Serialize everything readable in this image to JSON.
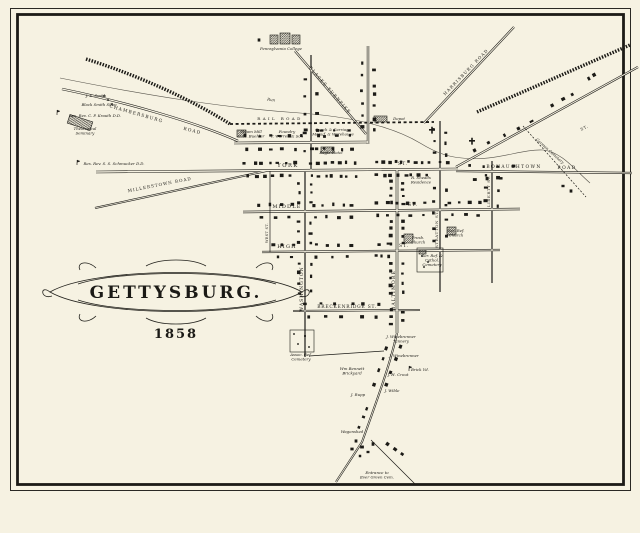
{
  "title": {
    "text": "GETTYSBURG.",
    "year": "1858"
  },
  "map": {
    "background": "#f6f2e2",
    "ink": "#1c1b17",
    "stream_color": "#55524a",
    "roads": [
      {
        "name": "stream-run",
        "kind": "stream",
        "d": "M 60 78 C 150 96 225 108 300 113 C 355 117 395 128 420 143 C 438 154 450 157 462 158 C 495 162 520 149 543 150 C 562 152 575 170 590 183"
      },
      {
        "name": "chambersburg-road",
        "kind": "double",
        "w": 2.4,
        "d": "M 62 89 C 125 102 195 122 238 141"
      },
      {
        "name": "blacks-turnpike",
        "kind": "double",
        "w": 2.2,
        "d": "M 295 51 L 366 134"
      },
      {
        "name": "harrisburg-road",
        "kind": "double",
        "w": 2.2,
        "d": "M 514 27 L 424 123"
      },
      {
        "name": "carlisle-st",
        "kind": "double",
        "w": 2.4,
        "d": "M 368 46 L 368 144"
      },
      {
        "name": "washington-st-north",
        "kind": "double",
        "w": 2,
        "d": "M 311 55 L 311 170"
      },
      {
        "name": "chambersburg-st",
        "kind": "double",
        "w": 2.6,
        "d": "M 234 143 L 368 142"
      },
      {
        "name": "york-st",
        "kind": "double",
        "w": 2.6,
        "d": "M 96 172 L 458 169"
      },
      {
        "name": "middle-st",
        "kind": "double",
        "w": 2.4,
        "d": "M 243 212 L 520 209"
      },
      {
        "name": "high-st",
        "kind": "double",
        "w": 2.2,
        "d": "M 262 252 L 500 250"
      },
      {
        "name": "breckenridge-st",
        "kind": "double",
        "w": 2,
        "d": "M 293 311 L 420 310"
      },
      {
        "name": "west-st",
        "kind": "thin",
        "d": "M 270 171 L 270 252"
      },
      {
        "name": "washington-st-south",
        "kind": "double",
        "w": 2,
        "d": "M 305 170 L 305 357"
      },
      {
        "name": "baltimore-st",
        "kind": "double",
        "w": 2.6,
        "d": "M 397 169 L 397 333"
      },
      {
        "name": "stratton-st",
        "kind": "double",
        "w": 2,
        "d": "M 440 121 L 440 292"
      },
      {
        "name": "liberty-st",
        "kind": "double",
        "w": 2,
        "d": "M 492 161 L 492 283"
      },
      {
        "name": "bonaughtown-road",
        "kind": "double",
        "w": 2.2,
        "d": "M 456 171 L 632 173"
      },
      {
        "name": "york-pike",
        "kind": "double",
        "w": 2.2,
        "d": "M 456 167 L 638 67"
      },
      {
        "name": "baltimore-pike-south",
        "kind": "double",
        "w": 2,
        "d": "M 397 333 C 390 365 377 400 362 442 L 336 482"
      },
      {
        "name": "millerstown-road",
        "kind": "double",
        "w": 2,
        "d": "M 95 208 L 266 171"
      },
      {
        "name": "evergreen-cemetery-lane",
        "kind": "thin",
        "d": "M 371 440 L 415 484"
      },
      {
        "name": "cemetery-lane-west",
        "kind": "thin",
        "d": "M 309 356 L 384 351"
      },
      {
        "name": "german-cemetery-lane",
        "kind": "lane",
        "d": "M 523 126 L 586 197"
      },
      {
        "name": "railroad-northwest",
        "kind": "band",
        "d": "M 86 59 C 140 76 192 100 230 124"
      },
      {
        "name": "railroad-center",
        "kind": "dash",
        "d": "M 230 124 L 434 122"
      },
      {
        "name": "railroad-northeast",
        "kind": "band",
        "d": "M 477 112 L 630 45"
      }
    ],
    "street_labels": [
      {
        "t": "RAIL ROAD",
        "x": 280,
        "y": 120,
        "r": 0,
        "s": 4,
        "sp": 2.4
      },
      {
        "t": "YORK",
        "x": 288,
        "y": 167,
        "r": 0,
        "s": 5.2,
        "sp": 1.5
      },
      {
        "t": "ST.",
        "x": 403,
        "y": 165,
        "r": 0,
        "s": 4.6,
        "sp": 1
      },
      {
        "t": "MIDDLE",
        "x": 287,
        "y": 208,
        "r": 0,
        "s": 5,
        "sp": 1.2
      },
      {
        "t": "ST.",
        "x": 413,
        "y": 206,
        "r": 0,
        "s": 4.6,
        "sp": 1
      },
      {
        "t": "HIGH",
        "x": 287,
        "y": 248,
        "r": 0,
        "s": 5,
        "sp": 1.2
      },
      {
        "t": "ST.",
        "x": 404,
        "y": 247,
        "r": 0,
        "s": 4.6,
        "sp": 1
      },
      {
        "t": "BRECKENRIDGE ST.",
        "x": 347,
        "y": 308,
        "r": 0,
        "s": 4.4,
        "sp": 0.8
      },
      {
        "t": "WASHINGTON",
        "x": 303,
        "y": 289,
        "r": -90,
        "s": 4.6,
        "sp": 1
      },
      {
        "t": "BALTIMORE",
        "x": 395,
        "y": 290,
        "r": -90,
        "s": 4.6,
        "sp": 1.2
      },
      {
        "t": "STRATTON ST.",
        "x": 438,
        "y": 229,
        "r": -90,
        "s": 4,
        "sp": 0.6
      },
      {
        "t": "LIBERTY ST.",
        "x": 490,
        "y": 191,
        "r": -90,
        "s": 4,
        "sp": 0.6
      },
      {
        "t": "WEST ST.",
        "x": 268,
        "y": 233,
        "r": -90,
        "s": 3.4,
        "sp": 0.4
      },
      {
        "t": "BONAUGHTOWN",
        "x": 514,
        "y": 168,
        "r": 0,
        "s": 4.4,
        "sp": 1.4
      },
      {
        "t": "ROAD",
        "x": 567,
        "y": 169,
        "r": 0,
        "s": 4.4,
        "sp": 1.4
      },
      {
        "t": "CHAMBERSBURG",
        "x": 136,
        "y": 115,
        "r": 16,
        "s": 4.4,
        "sp": 1.2
      },
      {
        "t": "ROAD",
        "x": 192,
        "y": 132,
        "r": 14,
        "s": 4.4,
        "sp": 1.2
      },
      {
        "t": "MILLERSTOWN ROAD",
        "x": 160,
        "y": 186,
        "r": -11,
        "s": 4.2,
        "sp": 1
      },
      {
        "t": "BLACKS TURNPIKE",
        "x": 329,
        "y": 91,
        "r": 49,
        "s": 4.2,
        "sp": 1.2
      },
      {
        "t": "HARRISBURG ROAD",
        "x": 467,
        "y": 73,
        "r": -46,
        "s": 4.2,
        "sp": 1.2
      },
      {
        "t": "ST.",
        "x": 585,
        "y": 129,
        "r": -27,
        "s": 4,
        "sp": 0.8
      }
    ],
    "script_labels": [
      {
        "l": [
          "Pennsylvania College"
        ],
        "x": 281,
        "y": 50
      },
      {
        "l": [
          "J. S. Smith"
        ],
        "x": 96,
        "y": 97
      },
      {
        "l": [
          "Black Smith Shop"
        ],
        "x": 99,
        "y": 106
      },
      {
        "l": [
          "Res. Rev. C. P. Krauth D.D."
        ],
        "x": 95,
        "y": 117
      },
      {
        "l": [
          "Theological",
          "Seminary"
        ],
        "x": 85,
        "y": 130
      },
      {
        "l": [
          "Res. Rev. S. S. Schmucker D.D."
        ],
        "x": 114,
        "y": 165
      },
      {
        "l": [
          "Run"
        ],
        "x": 271,
        "y": 101,
        "r": 8
      },
      {
        "l": [
          "Steam Mill",
          "C. H. Buehler"
        ],
        "x": 251,
        "y": 133
      },
      {
        "l": [
          "Foundry",
          "T. Warren & Son"
        ],
        "x": 287,
        "y": 133
      },
      {
        "l": [
          "Coach & Carriage",
          "Manuf. & Warehouse"
        ],
        "x": 333,
        "y": 131
      },
      {
        "l": [
          "Depot"
        ],
        "x": 399,
        "y": 120
      },
      {
        "l": [
          "Eagle Hotel"
        ],
        "x": 331,
        "y": 154
      },
      {
        "l": [
          "R. Sheads",
          "Residence"
        ],
        "x": 421,
        "y": 179
      },
      {
        "l": [
          "Presb.",
          "Church"
        ],
        "x": 418,
        "y": 239
      },
      {
        "l": [
          "Ger. Ref.",
          "Church"
        ],
        "x": 456,
        "y": 232
      },
      {
        "l": [
          "Ger. Ref. &",
          "Cathol.",
          "Cemetery"
        ],
        "x": 432,
        "y": 257
      },
      {
        "l": [
          "Assoc. Ref.",
          "Cemetery"
        ],
        "x": 301,
        "y": 356
      },
      {
        "l": [
          "J. Winebrenner",
          "Tannery"
        ],
        "x": 401,
        "y": 338
      },
      {
        "l": [
          "J. Winebrenner"
        ],
        "x": 404,
        "y": 357
      },
      {
        "l": [
          "Wm Bennett",
          "Brickyard"
        ],
        "x": 352,
        "y": 370
      },
      {
        "l": [
          "J. H. Crout"
        ],
        "x": 398,
        "y": 376
      },
      {
        "l": [
          "Brick Yd."
        ],
        "x": 420,
        "y": 371
      },
      {
        "l": [
          "J. Rupp"
        ],
        "x": 358,
        "y": 396
      },
      {
        "l": [
          "J. Wible"
        ],
        "x": 392,
        "y": 392
      },
      {
        "l": [
          "Wagonshed"
        ],
        "x": 352,
        "y": 433
      },
      {
        "l": [
          "Entrance to",
          "Ever Green Cem."
        ],
        "x": 377,
        "y": 474
      },
      {
        "l": [
          "German Cemetery"
        ],
        "x": 549,
        "y": 152,
        "r": 42
      }
    ],
    "building_rows": [
      [
        242,
        163,
        298,
        163,
        7
      ],
      [
        308,
        163,
        358,
        163,
        7
      ],
      [
        372,
        162,
        432,
        162,
        9
      ],
      [
        436,
        162,
        452,
        162,
        2
      ],
      [
        242,
        176,
        296,
        176,
        6
      ],
      [
        308,
        176,
        358,
        176,
        7
      ],
      [
        372,
        175,
        430,
        175,
        8
      ],
      [
        240,
        136,
        356,
        136,
        10
      ],
      [
        242,
        149,
        300,
        149,
        5
      ],
      [
        308,
        149,
        356,
        149,
        5
      ],
      [
        300,
        130,
        356,
        130,
        4
      ],
      [
        252,
        205,
        298,
        205,
        4
      ],
      [
        310,
        205,
        356,
        205,
        5
      ],
      [
        372,
        203,
        430,
        203,
        6
      ],
      [
        444,
        203,
        486,
        203,
        4
      ],
      [
        252,
        217,
        298,
        217,
        3
      ],
      [
        310,
        217,
        356,
        217,
        4
      ],
      [
        372,
        215,
        428,
        215,
        5
      ],
      [
        446,
        215,
        484,
        215,
        3
      ],
      [
        268,
        245,
        298,
        245,
        3
      ],
      [
        310,
        245,
        356,
        245,
        4
      ],
      [
        374,
        244,
        394,
        244,
        2
      ],
      [
        272,
        257,
        298,
        257,
        2
      ],
      [
        310,
        257,
        354,
        257,
        3
      ],
      [
        372,
        256,
        392,
        256,
        3
      ],
      [
        298,
        304,
        388,
        304,
        6
      ],
      [
        300,
        317,
        386,
        317,
        5
      ],
      [
        299,
        179,
        299,
        207,
        3
      ],
      [
        299,
        217,
        299,
        247,
        3
      ],
      [
        299,
        259,
        299,
        299,
        4
      ],
      [
        311,
        179,
        311,
        207,
        3
      ],
      [
        311,
        219,
        311,
        247,
        3
      ],
      [
        311,
        259,
        311,
        297,
        3
      ],
      [
        305,
        70,
        305,
        158,
        5
      ],
      [
        317,
        86,
        317,
        158,
        4
      ],
      [
        362,
        58,
        362,
        136,
        6
      ],
      [
        374,
        66,
        374,
        136,
        6
      ],
      [
        391,
        179,
        391,
        207,
        4
      ],
      [
        391,
        217,
        391,
        247,
        4
      ],
      [
        391,
        259,
        391,
        297,
        5
      ],
      [
        391,
        307,
        391,
        327,
        3
      ],
      [
        403,
        179,
        403,
        207,
        4
      ],
      [
        403,
        217,
        403,
        247,
        4
      ],
      [
        403,
        259,
        403,
        297,
        4
      ],
      [
        403,
        307,
        403,
        325,
        2
      ],
      [
        434,
        124,
        434,
        158,
        3
      ],
      [
        434,
        181,
        434,
        247,
        5
      ],
      [
        446,
        127,
        446,
        161,
        3
      ],
      [
        446,
        183,
        446,
        245,
        4
      ],
      [
        486,
        168,
        486,
        208,
        3
      ],
      [
        498,
        172,
        498,
        212,
        3
      ],
      [
        462,
        166,
        520,
        166,
        4
      ],
      [
        468,
        179,
        508,
        179,
        3
      ],
      [
        468,
        154,
        540,
        117,
        5
      ],
      [
        548,
        107,
        576,
        92,
        3
      ],
      [
        389,
        341,
        372,
        391,
        4
      ],
      [
        402,
        341,
        384,
        391,
        4
      ],
      [
        368,
        403,
        358,
        431,
        3
      ],
      [
        384,
        441,
        406,
        457,
        3
      ],
      [
        586,
        80,
        597,
        74,
        2
      ]
    ],
    "building_singles": [
      [
        356,
        441
      ],
      [
        362,
        447
      ],
      [
        368,
        452
      ],
      [
        373,
        444
      ],
      [
        360,
        456
      ],
      [
        352,
        449
      ],
      [
        563,
        186
      ],
      [
        571,
        191
      ],
      [
        259,
        40
      ]
    ],
    "marks": [
      [
        104,
        96
      ],
      [
        108,
        100
      ],
      [
        112,
        104
      ],
      [
        294,
        334
      ],
      [
        305,
        336
      ],
      [
        298,
        344
      ],
      [
        309,
        347
      ],
      [
        422,
        256
      ],
      [
        428,
        262
      ],
      [
        424,
        267
      ]
    ],
    "flags": [
      [
        57,
        113
      ],
      [
        77,
        163
      ],
      [
        409,
        369
      ]
    ],
    "churches": [
      [
        432,
        130
      ],
      [
        472,
        141
      ]
    ],
    "hatched_buildings": [
      [
        374,
        116,
        13,
        6,
        0
      ],
      [
        321,
        147,
        13,
        6,
        0
      ],
      [
        237,
        130,
        9,
        7,
        0
      ],
      [
        270,
        35,
        8,
        9,
        0
      ],
      [
        280,
        33,
        10,
        11,
        0
      ],
      [
        292,
        35,
        8,
        9,
        0
      ],
      [
        68,
        118,
        24,
        9,
        18
      ],
      [
        404,
        234,
        9,
        9,
        0
      ],
      [
        447,
        227,
        9,
        8,
        0
      ],
      [
        419,
        250,
        7,
        4,
        0
      ]
    ],
    "plots": [
      [
        290,
        330,
        24,
        22
      ],
      [
        417,
        248,
        26,
        24
      ]
    ]
  }
}
